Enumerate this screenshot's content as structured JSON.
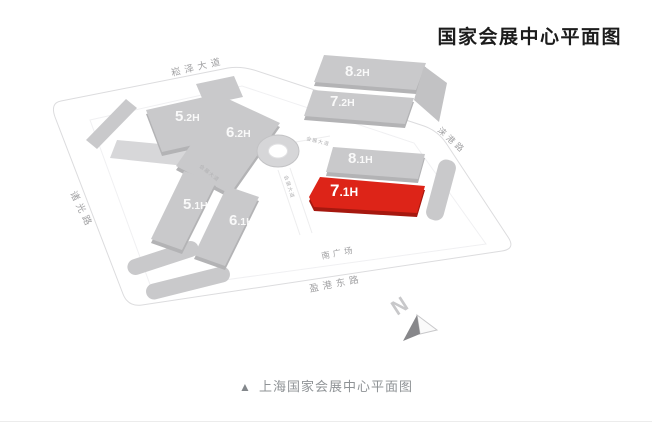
{
  "title": "国家会展中心平面图",
  "caption": {
    "marker": "▲",
    "text": "上海国家会展中心平面图"
  },
  "map": {
    "halls": [
      {
        "name": "5.2H",
        "num": "5",
        "suffix": ".2H",
        "highlighted": false
      },
      {
        "name": "6.2H",
        "num": "6",
        "suffix": ".2H",
        "highlighted": false
      },
      {
        "name": "8.2H",
        "num": "8",
        "suffix": ".2H",
        "highlighted": false
      },
      {
        "name": "7.2H",
        "num": "7",
        "suffix": ".2H",
        "highlighted": false
      },
      {
        "name": "8.1H",
        "num": "8",
        "suffix": ".1H",
        "highlighted": false
      },
      {
        "name": "7.1H",
        "num": "7",
        "suffix": ".1H",
        "highlighted": true
      },
      {
        "name": "5.1H",
        "num": "5",
        "suffix": ".1H",
        "highlighted": false
      },
      {
        "name": "6.1H",
        "num": "6",
        "suffix": ".1H",
        "highlighted": false
      }
    ],
    "roads": [
      {
        "name": "崧泽大道"
      },
      {
        "name": "诸光路"
      },
      {
        "name": "涞港路"
      },
      {
        "name": "南广场"
      },
      {
        "name": "盈港东路"
      },
      {
        "name": "会展大道"
      }
    ],
    "compass": {
      "label": "N"
    },
    "colors": {
      "highlight": "#dd2418",
      "building": "#c9c9cb",
      "road_label": "#a2a2a4",
      "title_text": "#1c1c1c",
      "caption_text": "#8f9396"
    }
  }
}
